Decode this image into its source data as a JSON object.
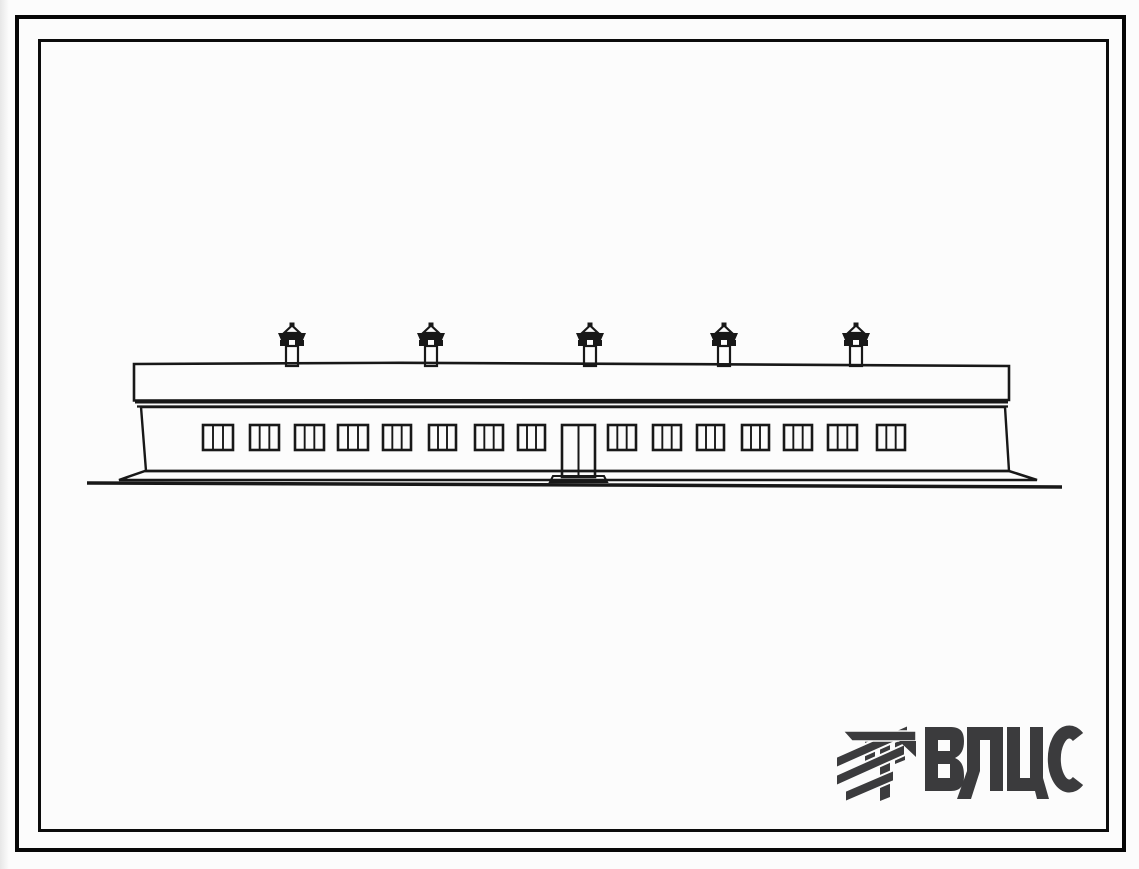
{
  "page": {
    "background": "#fcfcfc",
    "frame_color": "#0a0a0a",
    "description": "Scanned sheet of a standard-design album: front elevation of a long single-storey building, double ruled border, VCIS watermark logo bottom right"
  },
  "drawing": {
    "title": "single-storey-building-front-elevation",
    "ink": "#181818",
    "fascia": {
      "x1": 134,
      "y_top": 364,
      "x2": 1009,
      "y_bottom": 400
    },
    "cornice": {
      "x1": 135,
      "x2": 1008,
      "y1": 402,
      "y2": 406.5
    },
    "wall": {
      "top_left": [
        141,
        407
      ],
      "top_right": [
        1005,
        407
      ],
      "bottom_right": [
        1009,
        471
      ],
      "bottom_left": [
        146,
        471
      ]
    },
    "plinth": {
      "points": [
        [
          145,
          471
        ],
        [
          1009,
          471
        ],
        [
          1037,
          480
        ],
        [
          119,
          480
        ]
      ]
    },
    "ground": {
      "x1": 87,
      "y1": 483,
      "xm": 600,
      "ym": 485,
      "x2": 1062,
      "y2": 487
    },
    "windows": {
      "y": 425,
      "height": 25,
      "panes": 3,
      "items": [
        [
          203,
          30
        ],
        [
          250,
          29
        ],
        [
          295,
          29
        ],
        [
          338,
          30
        ],
        [
          383,
          28
        ],
        [
          429,
          27
        ],
        [
          475,
          28
        ],
        [
          518,
          27
        ],
        [
          608,
          28
        ],
        [
          653,
          28
        ],
        [
          697,
          27
        ],
        [
          742,
          27
        ],
        [
          784,
          28
        ],
        [
          828,
          29
        ],
        [
          877,
          28
        ]
      ]
    },
    "door": {
      "x": 562,
      "y": 425,
      "width": 33,
      "height": 52,
      "leaves": 2,
      "threshold": [
        [
          553,
          476
        ],
        [
          604,
          476
        ],
        [
          607,
          482
        ],
        [
          550,
          482
        ]
      ]
    },
    "vents": {
      "centers": [
        292,
        431,
        590,
        724,
        856
      ],
      "stack_width": 12,
      "stack_top": 346,
      "roof_y": 366
    }
  },
  "logo": {
    "text": "ВЦИС",
    "color": "#3b3b3d",
    "icon": "hatched-columns-mark"
  }
}
